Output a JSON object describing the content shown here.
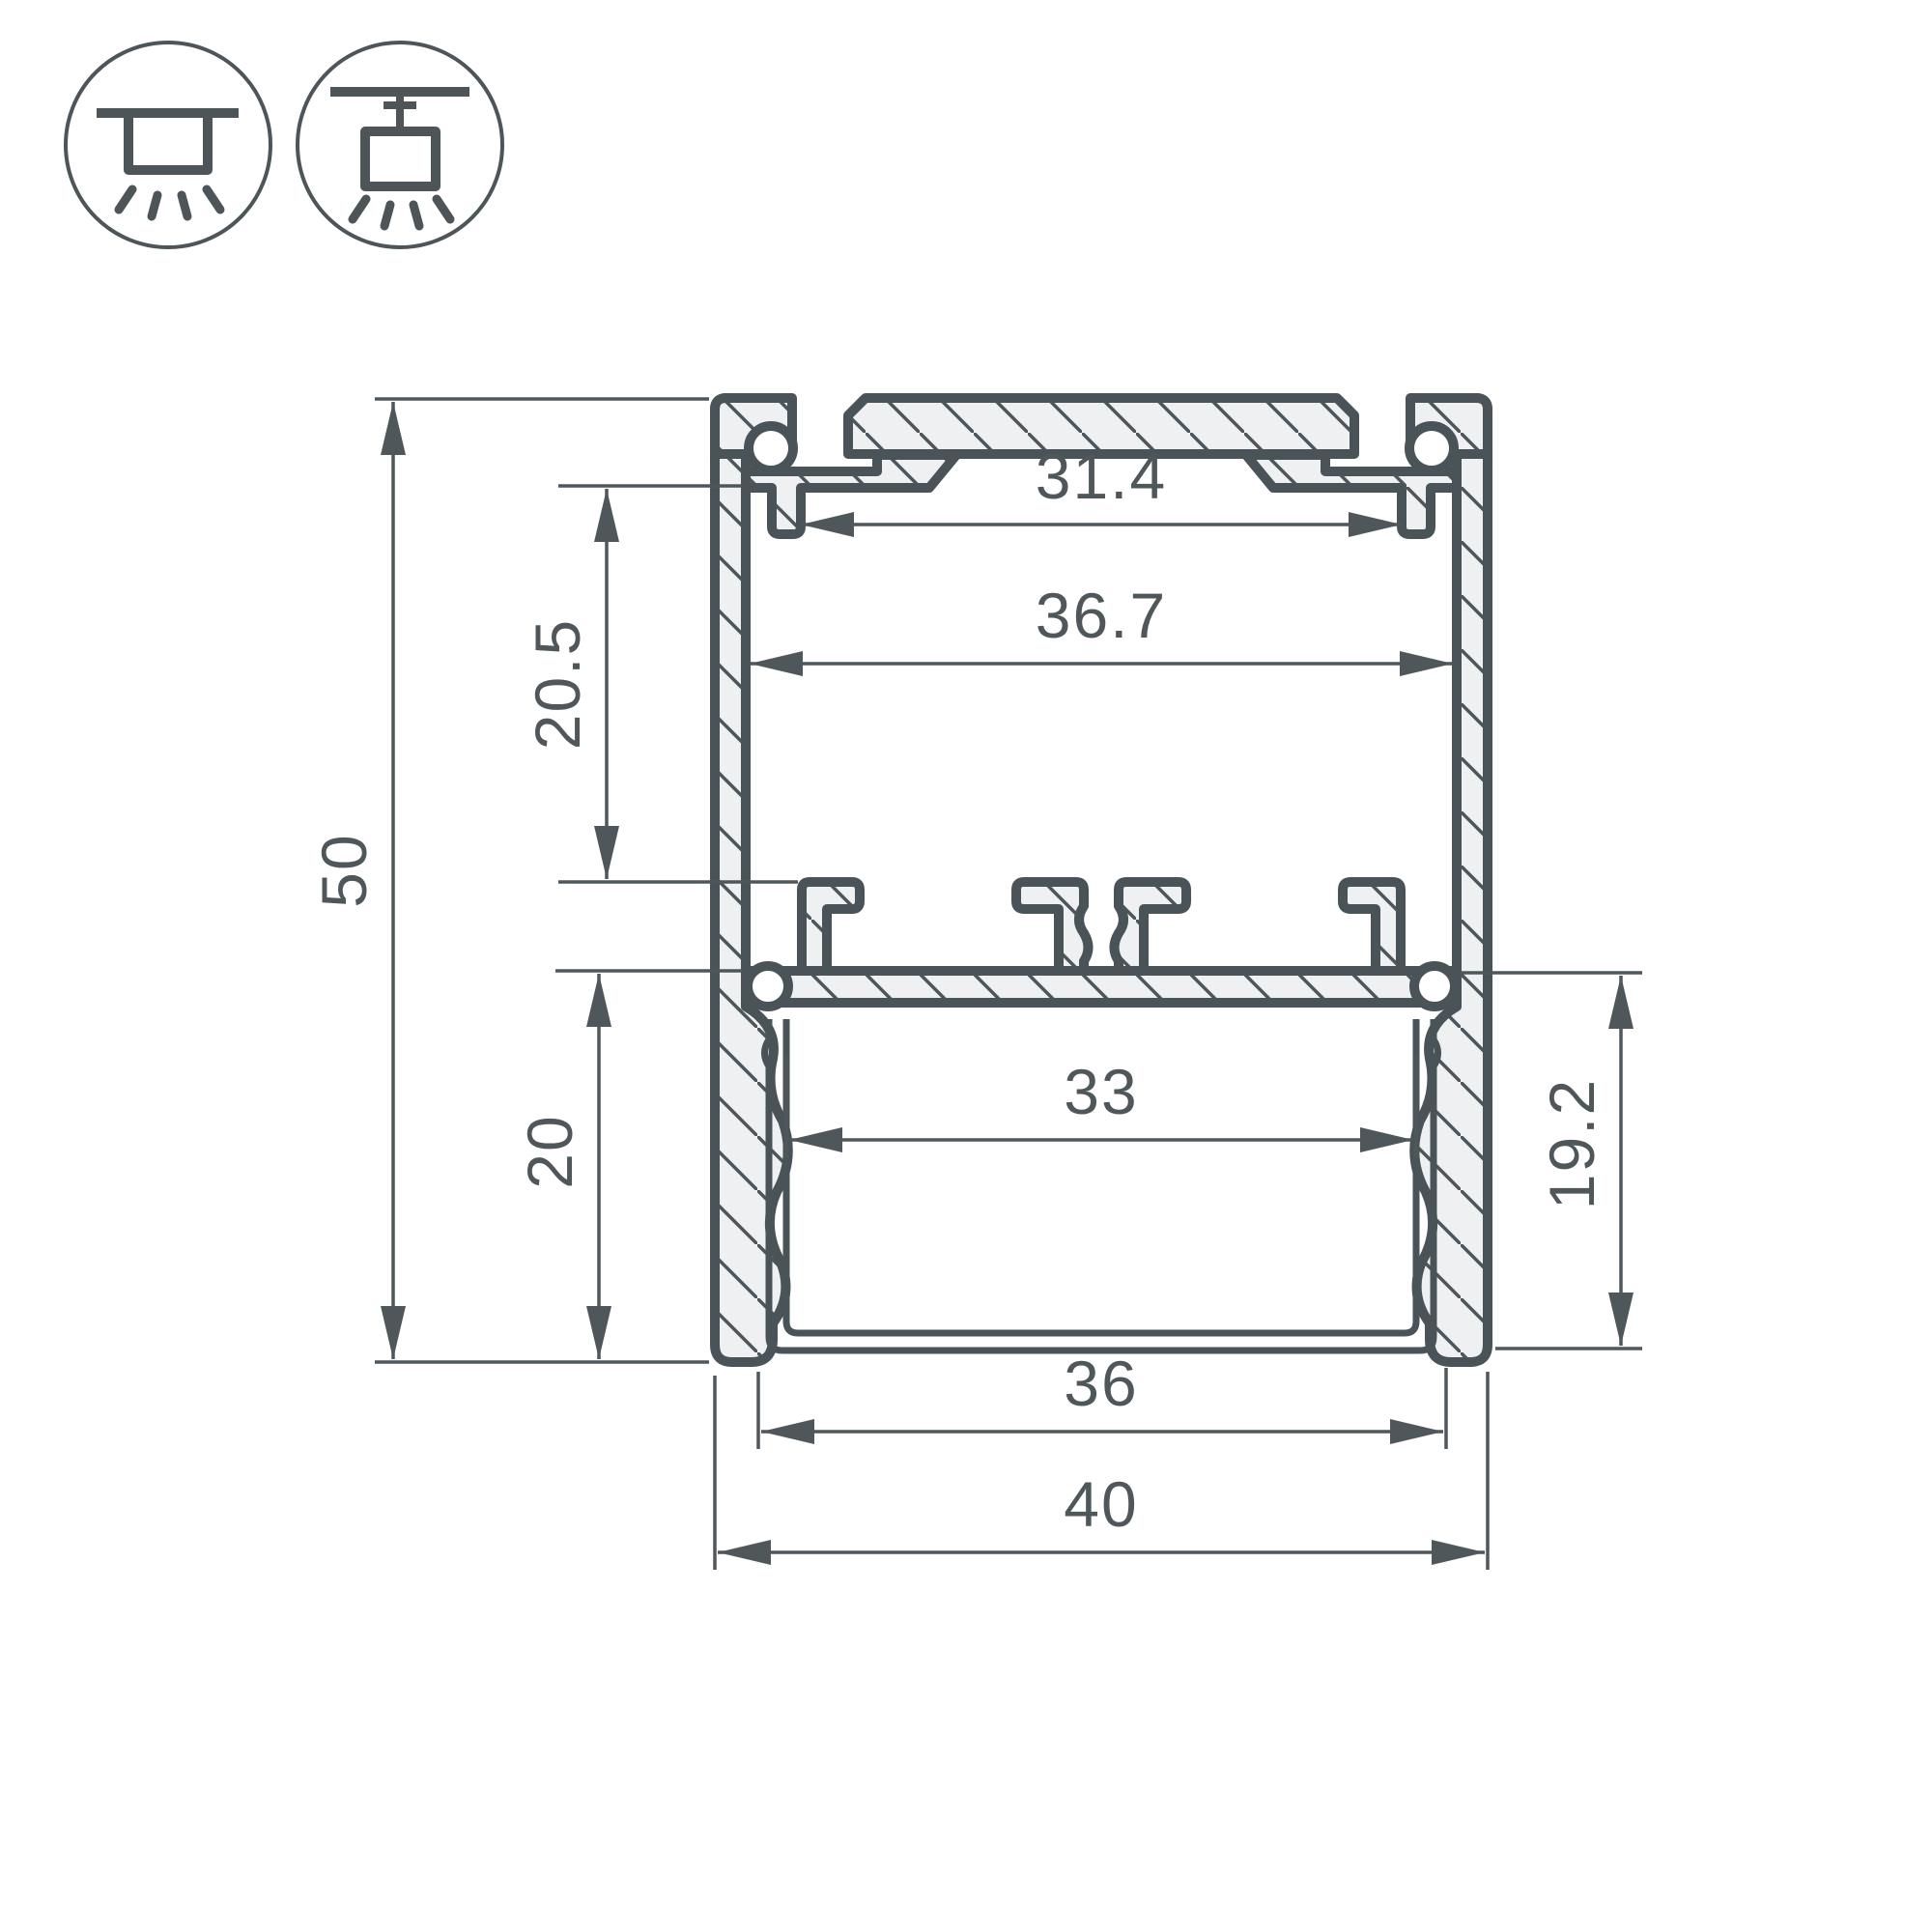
{
  "drawing": {
    "type": "aluminium-led-profile-cross-section",
    "dims": {
      "top_slot_width": "31.4",
      "inner_width": "36.7",
      "upper_cavity_height": "20.5",
      "overall_height": "50",
      "lower_cavity_height": "20",
      "pcb_shelf_width": "33",
      "inner_depth": "19.2",
      "bottom_opening_width": "36",
      "overall_width": "40"
    },
    "colors": {
      "outline": "#4a5357",
      "metal_fill": "#eef0f1",
      "dimension": "#4f575a",
      "background": "#ffffff"
    },
    "icons": {
      "first": "surface-mount-ceiling-light",
      "second": "suspended-pendant-light"
    }
  }
}
